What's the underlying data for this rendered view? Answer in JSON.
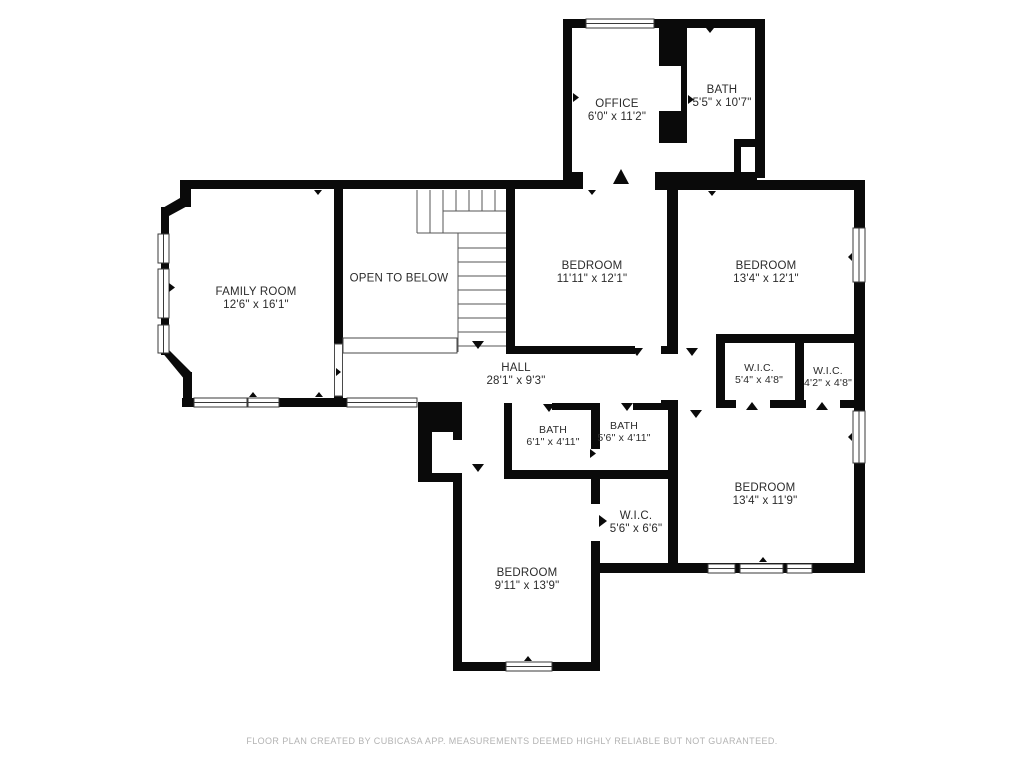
{
  "title": "Second floor plan",
  "rooms": [
    {
      "id": "office",
      "name": "OFFICE",
      "dims": "6'0\" x 11'2\""
    },
    {
      "id": "bath-top",
      "name": "BATH",
      "dims": "5'5\" x 10'7\""
    },
    {
      "id": "family-room",
      "name": "FAMILY ROOM",
      "dims": "12'6\" x 16'1\""
    },
    {
      "id": "open-to-below",
      "name": "OPEN TO BELOW",
      "dims": ""
    },
    {
      "id": "bedroom-1",
      "name": "BEDROOM",
      "dims": "11'11\" x 12'1\""
    },
    {
      "id": "bedroom-2",
      "name": "BEDROOM",
      "dims": "13'4\" x 12'1\""
    },
    {
      "id": "hall",
      "name": "HALL",
      "dims": "28'1\" x 9'3\""
    },
    {
      "id": "wic-1",
      "name": "W.I.C.",
      "dims": "5'4\" x 4'8\""
    },
    {
      "id": "wic-2",
      "name": "W.I.C.",
      "dims": "4'2\" x 4'8\""
    },
    {
      "id": "bath-1",
      "name": "BATH",
      "dims": "6'1\" x 4'11\""
    },
    {
      "id": "bath-2",
      "name": "BATH",
      "dims": "5'6\" x 4'11\""
    },
    {
      "id": "wic-3",
      "name": "W.I.C.",
      "dims": "5'6\" x 6'6\""
    },
    {
      "id": "bedroom-3",
      "name": "BEDROOM",
      "dims": "13'4\" x 11'9\""
    },
    {
      "id": "bedroom-4",
      "name": "BEDROOM",
      "dims": "9'11\" x 13'9\""
    }
  ],
  "footer": {
    "disclaimer": "FLOOR PLAN CREATED BY CUBICASA APP. MEASUREMENTS DEEMED HIGHLY RELIABLE BUT NOT GUARANTEED."
  },
  "colors": {
    "background": "#ffffff",
    "wall": "#0a0a0a",
    "label": "#2b2b2b",
    "thin_line": "#555555",
    "footer_text": "#b3b3b3"
  }
}
